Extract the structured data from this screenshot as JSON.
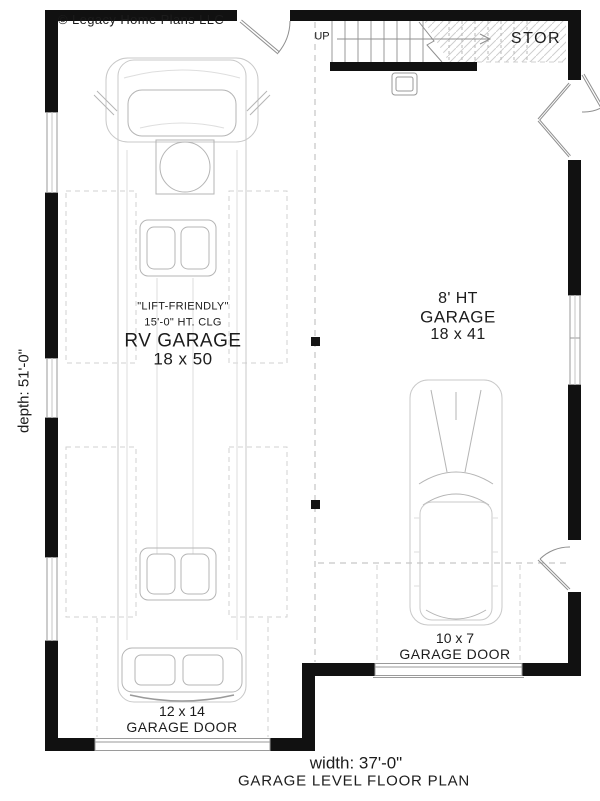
{
  "page": {
    "copyright": "© Legacy Home Plans LLC",
    "title": "GARAGE LEVEL FLOOR PLAN",
    "width_label": "width: 37'-0\"",
    "depth_label": "depth: 51'-0\""
  },
  "rooms": {
    "rv_garage": {
      "note1": "\"LIFT-FRIENDLY\"",
      "note2": "15'-0\" HT. CLG",
      "name": "RV GARAGE",
      "size": "18 x 50"
    },
    "garage": {
      "height_note": "8' HT",
      "name": "GARAGE",
      "size": "18 x 41"
    },
    "storage": {
      "name": "STOR"
    },
    "stairs": {
      "direction": "UP"
    }
  },
  "doors": {
    "rv_garage_door": {
      "size": "12 x 14",
      "label": "GARAGE DOOR"
    },
    "garage_door": {
      "size": "10 x 7",
      "label": "GARAGE DOOR"
    }
  },
  "colors": {
    "wall": "#111111",
    "line": "#999999",
    "vehicle": "#c8c8c8",
    "dashed": "#b9b9b9",
    "text": "#1c1c1c"
  }
}
